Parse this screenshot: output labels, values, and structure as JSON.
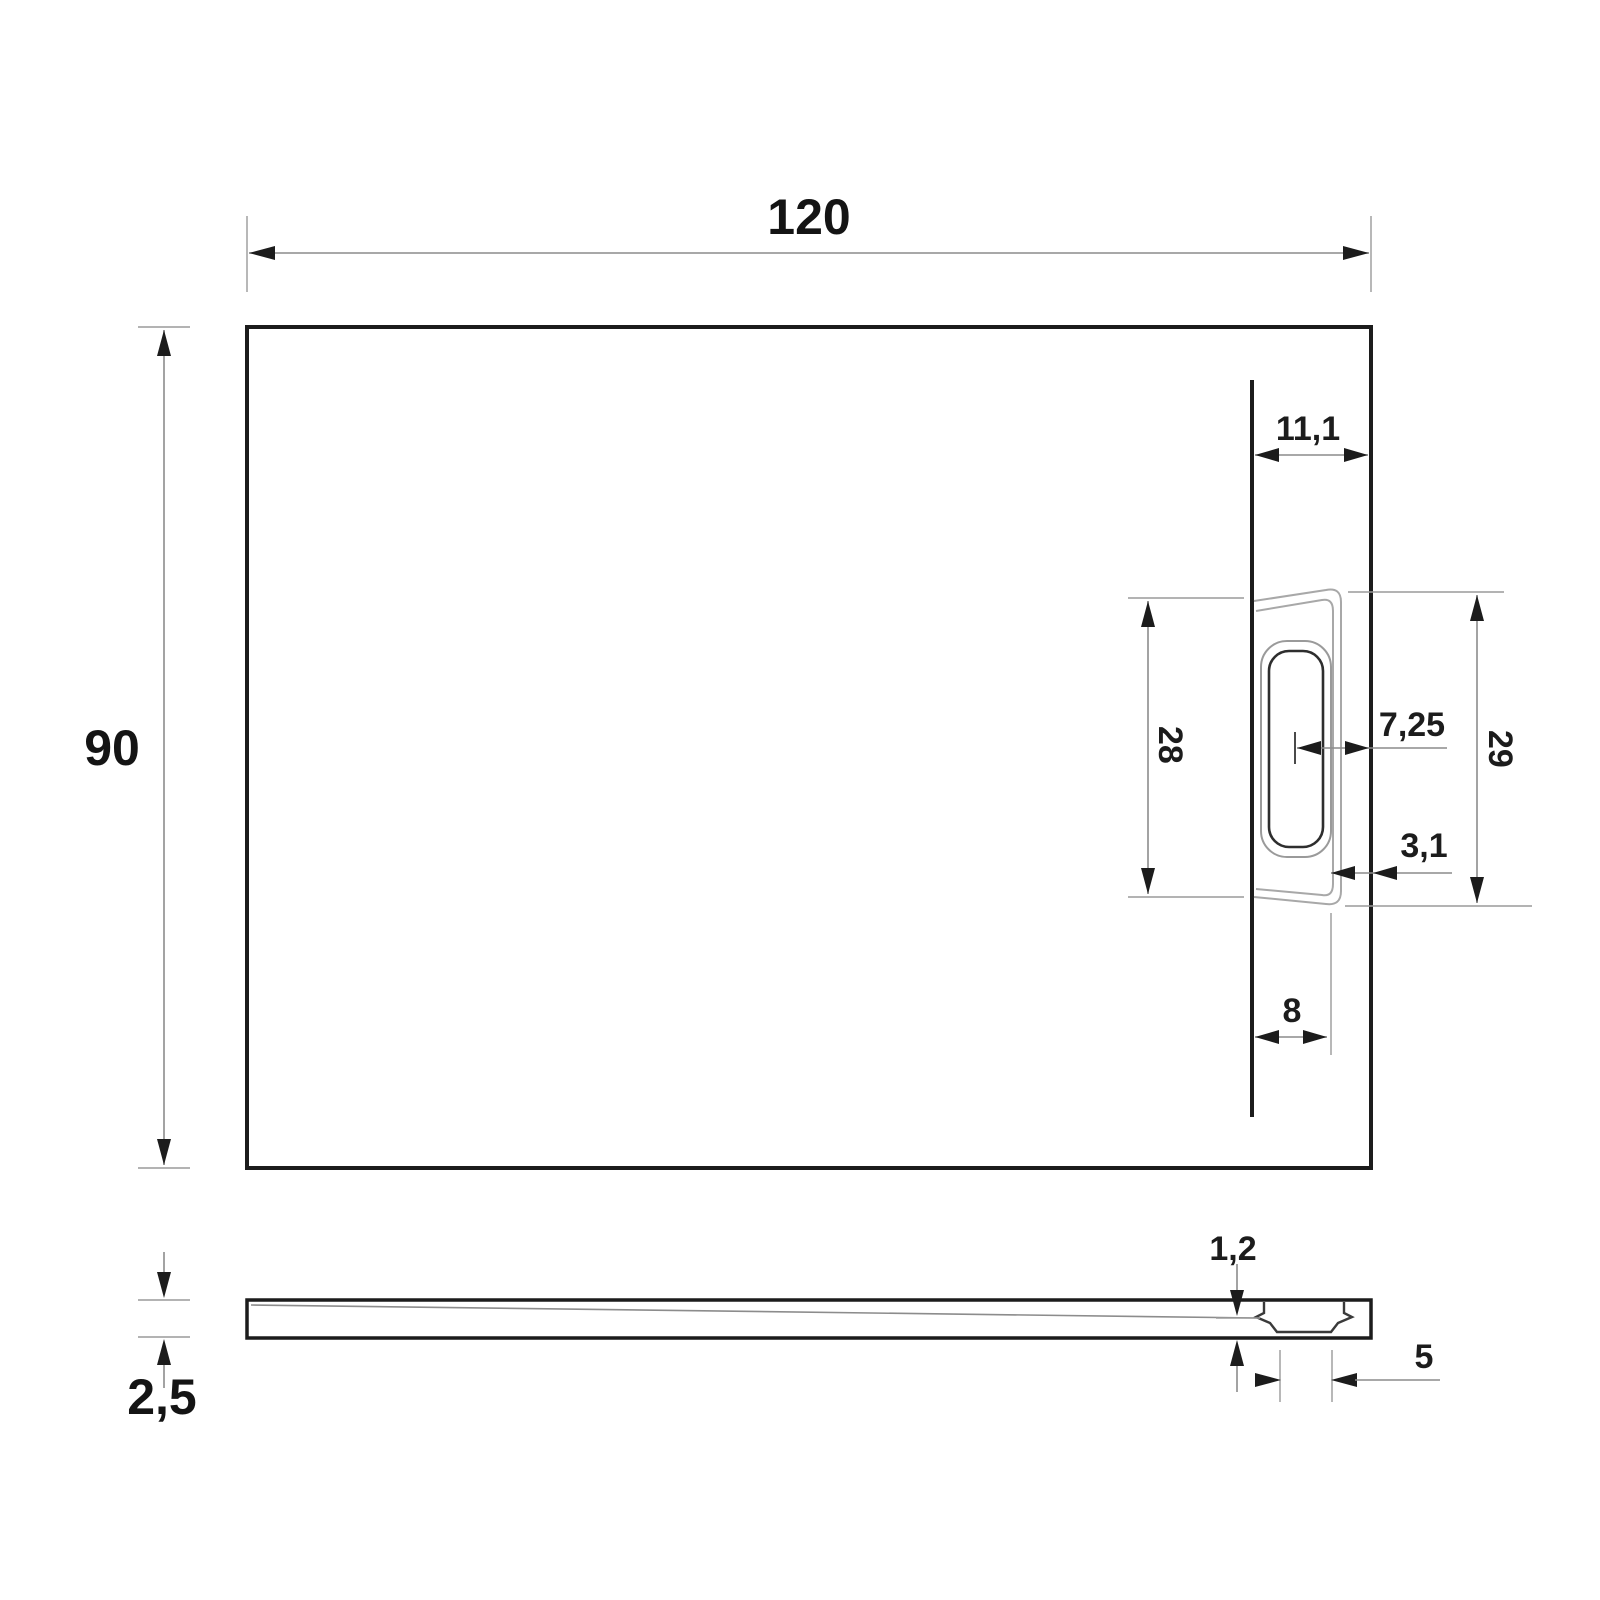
{
  "drawing": {
    "type": "technical-dimension-drawing",
    "views": {
      "plan": {
        "labels": {
          "overall_width": "120",
          "overall_depth": "90",
          "drain_line_to_edge": "11,1",
          "cutout_inner_height": "28",
          "drain_center_to_edge": "7,25",
          "cutout_outer_height": "29",
          "cover_edge_gap": "3,1",
          "drain_line_to_cover": "8"
        }
      },
      "profile": {
        "labels": {
          "min_thickness": "1,2",
          "edge_thickness": "2,5",
          "trap_width": "5"
        }
      }
    },
    "colors": {
      "outline": "#1c1c1c",
      "dimension_lines": "#8c8c8c",
      "text": "#1c1c1c",
      "background": "#ffffff"
    }
  }
}
